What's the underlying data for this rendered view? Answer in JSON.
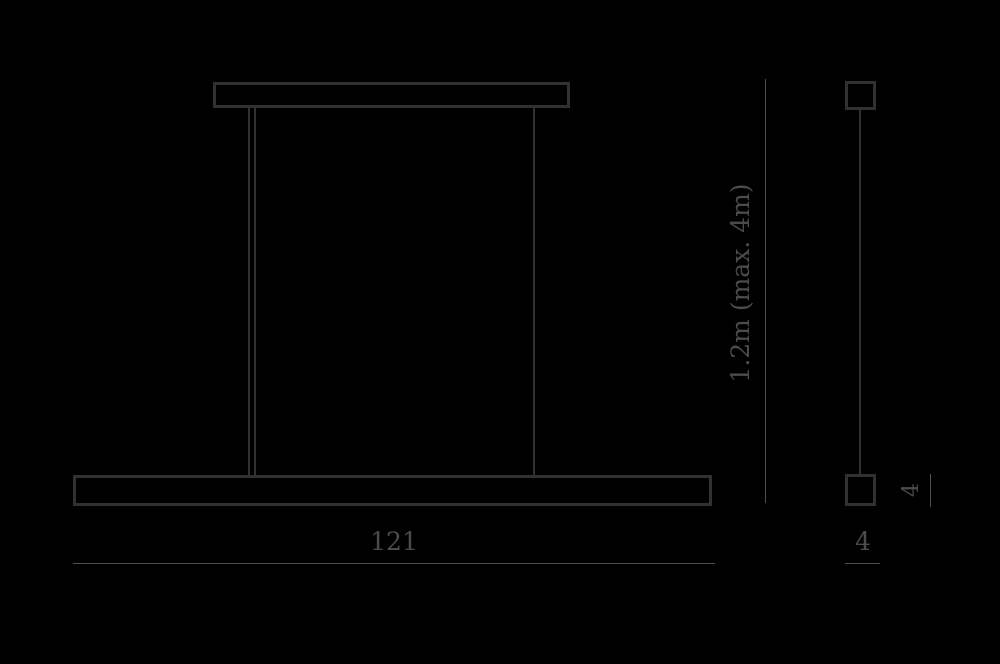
{
  "diagram": {
    "title": "linear-pendant-lamp-dimension-drawing",
    "colors": {
      "background": "#000000",
      "stroke": "#313131",
      "dimension": "#505050",
      "text": "#4c4c4c"
    },
    "front_view": {
      "width_label": "121",
      "drop_label": "1.2m (max. 4m)"
    },
    "side_view": {
      "profile_height_label": "4",
      "profile_width_label": "4"
    }
  }
}
